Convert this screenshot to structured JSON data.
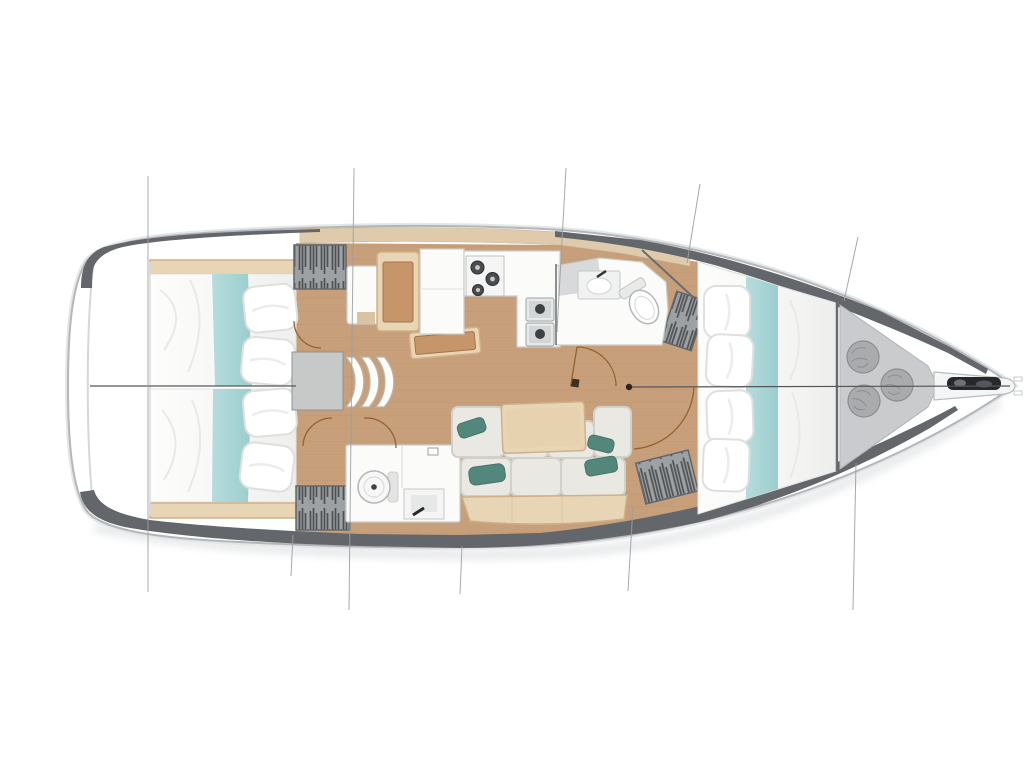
{
  "page": {
    "background": "#ffffff"
  },
  "palette": {
    "page_bg": "#ffffff",
    "hull_fill": "#ffffff",
    "hull_stroke": "#b4b7b9",
    "hull_glow": "#e4e6e7",
    "deck_band": "#63666a",
    "side_deck": "#dfcbac",
    "side_deck_line": "#cbb595",
    "floor_wood": "#c79f7b",
    "floor_line": "#b78f6a",
    "furn_wood_light": "#e8d5b6",
    "furn_wood_edge": "#cfb188",
    "furn_wood_mid": "#c6966a",
    "furn_wood_dark": "#a5754a",
    "white_furn": "#fbfbfa",
    "furn_stroke": "#cdcecb",
    "bed_stroke": "#e2e3e1",
    "pillow_stroke": "#dfe0dd",
    "teal_light": "#b6dcdc",
    "teal": "#a4d3d4",
    "teal_dark": "#54877c",
    "cushion": "#e9e8e2",
    "cushion_stroke": "#d0d1cb",
    "locker_gray": "#9ea1a4",
    "locker_stroke": "#64676a",
    "steel": "#c7c8c8",
    "centerline": "#54575a",
    "section_line": "#9aa0a3",
    "door_arc": "#96622f",
    "bag": "#a9abad",
    "bag_stroke": "#8c8e90",
    "anchor_dark": "#26292c",
    "shadow": "#dcdee0"
  },
  "diagram": {
    "type": "floor-plan",
    "subject": "sailboat-interior-layout-top-view",
    "orientation": "bow-right",
    "regions": [
      {
        "id": "aft-cabin-port"
      },
      {
        "id": "aft-cabin-starboard"
      },
      {
        "id": "companionway-steps"
      },
      {
        "id": "nav-station"
      },
      {
        "id": "galley"
      },
      {
        "id": "forward-head"
      },
      {
        "id": "aft-head"
      },
      {
        "id": "salon-settee"
      },
      {
        "id": "salon-table"
      },
      {
        "id": "forward-cabin"
      },
      {
        "id": "anchor-locker"
      },
      {
        "id": "bowsprit"
      }
    ]
  }
}
